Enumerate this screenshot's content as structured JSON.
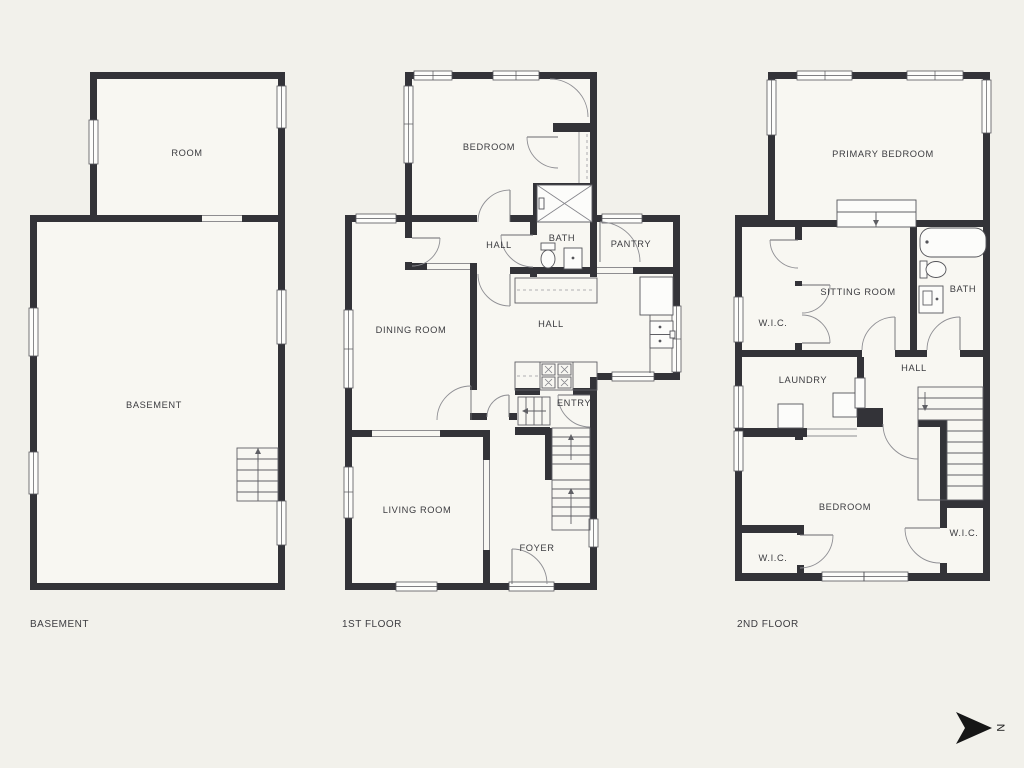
{
  "captions": {
    "basement": "BASEMENT",
    "first": "1ST FLOOR",
    "second": "2ND FLOOR"
  },
  "basement": {
    "room": "ROOM",
    "main": "BASEMENT"
  },
  "first": {
    "bedroom": "BEDROOM",
    "hall_upper": "HALL",
    "bath": "BATH",
    "pantry": "PANTRY",
    "dining": "DINING ROOM",
    "hall": "HALL",
    "entry": "ENTRY",
    "living": "LIVING ROOM",
    "foyer": "FOYER"
  },
  "second": {
    "primary": "PRIMARY BEDROOM",
    "wic_upper": "W.I.C.",
    "sitting": "SITTING ROOM",
    "bath": "BATH",
    "laundry": "LAUNDRY",
    "hall": "HALL",
    "bedroom": "BEDROOM",
    "wic_left": "W.I.C.",
    "wic_right": "W.I.C."
  },
  "compass": {
    "north": "N"
  },
  "colors": {
    "background": "#f2f1eb",
    "wall": "#333338",
    "text": "#3c3c40"
  }
}
